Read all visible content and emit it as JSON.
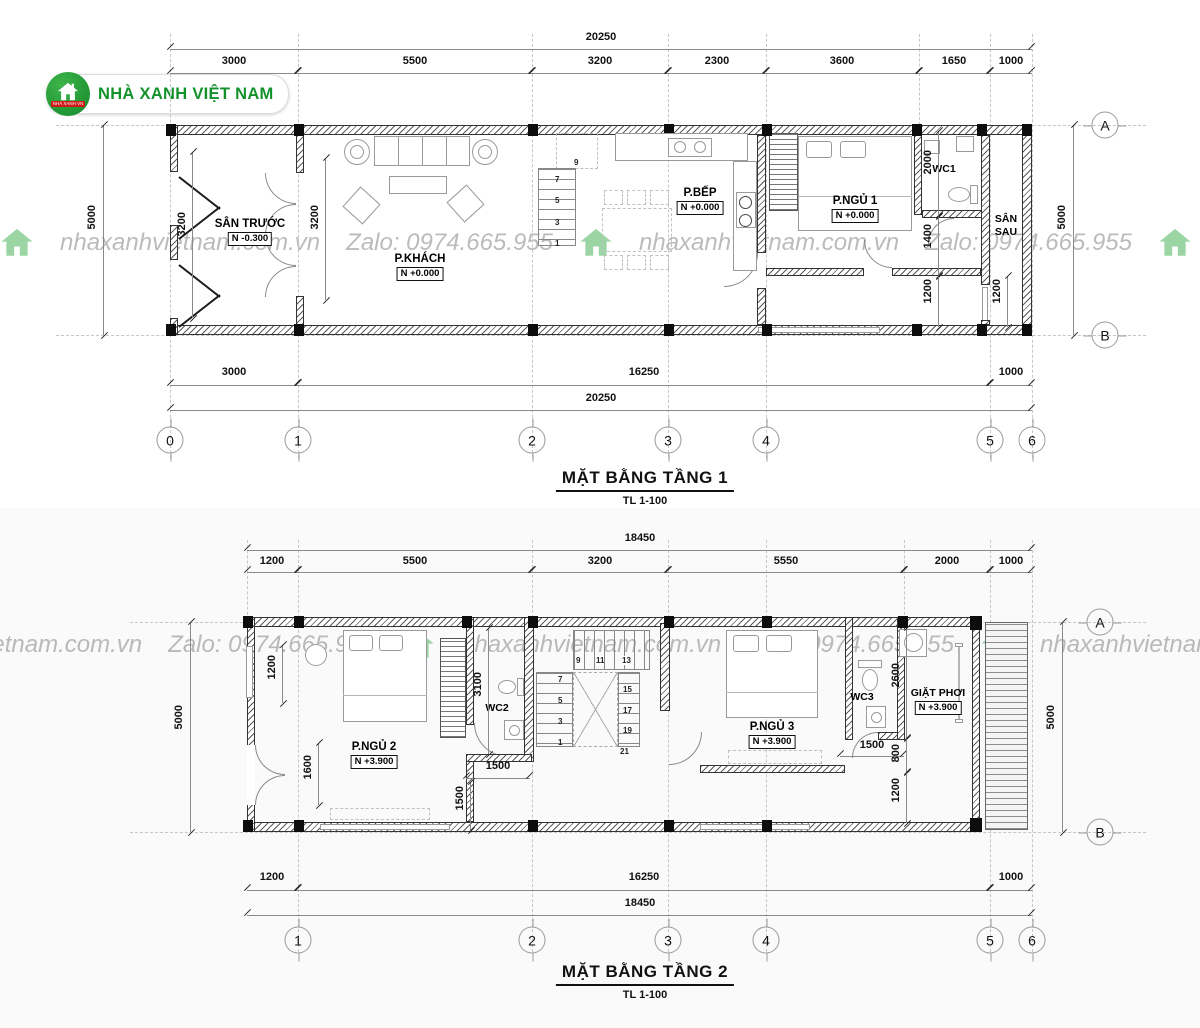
{
  "logo": {
    "name": "NHÀ XANH VIỆT NAM",
    "tag": "NHÀ XANH VN"
  },
  "watermark": {
    "site": "nhaxanhvietnam.com.vn",
    "zalo": "Zalo: 0974.665.955"
  },
  "colors": {
    "brand_green": "#1f9a31",
    "wall_black": "#111111",
    "line_gray": "#888888",
    "watermark_gray": "#9b9b9b"
  },
  "floor1": {
    "title": "MẶT BẰNG TẦNG 1",
    "scale": "TL 1-100",
    "top_total": "20250",
    "top_segments": [
      "3000",
      "5500",
      "3200",
      "2300",
      "3600",
      "1650",
      "1000"
    ],
    "bottom_segments": [
      "3000",
      "16250",
      "1000"
    ],
    "bottom_total": "20250",
    "side_total": "5000",
    "inner": {
      "san_truoc_w": "3200",
      "khach_w": "3200",
      "wc1_d": "2000",
      "hall_d": "1400",
      "back_d": "1200",
      "san_sau_d": "1200"
    },
    "grid_cols": [
      "0",
      "1",
      "2",
      "3",
      "4",
      "5",
      "6"
    ],
    "grid_rows": [
      "A",
      "B"
    ],
    "rooms": {
      "san_truoc": {
        "name": "SÂN TRƯỚC",
        "level": "N -0.300"
      },
      "khach": {
        "name": "P.KHÁCH",
        "level": "N +0.000"
      },
      "bep": {
        "name": "P.BẾP",
        "level": "N +0.000"
      },
      "ngu1": {
        "name": "P.NGỦ 1",
        "level": "N +0.000"
      },
      "wc1": {
        "name": "WC1"
      },
      "san_sau": {
        "line1": "SÂN",
        "line2": "SAU"
      }
    },
    "stair_numbers": [
      "1",
      "3",
      "5",
      "7",
      "9"
    ]
  },
  "floor2": {
    "title": "MẶT BẰNG TẦNG 2",
    "scale": "TL 1-100",
    "top_total": "18450",
    "top_segments": [
      "1200",
      "5500",
      "3200",
      "5550",
      "2000",
      "1000"
    ],
    "bottom_segments": [
      "1200",
      "16250",
      "1000"
    ],
    "bottom_total": "18450",
    "side_total": "5000",
    "inner": {
      "window_w": "1200",
      "door_w": "1600",
      "wc2_d": "3100",
      "wc2_w": "1500",
      "hall_w": "1500",
      "ngu3_w": "1500",
      "laundry_d": "2600",
      "ledge_d": "800",
      "back_d": "1200"
    },
    "grid_cols": [
      "1",
      "2",
      "3",
      "4",
      "5",
      "6"
    ],
    "grid_rows": [
      "A",
      "B"
    ],
    "rooms": {
      "ngu2": {
        "name": "P.NGỦ 2",
        "level": "N +3.900"
      },
      "wc2": {
        "name": "WC2"
      },
      "ngu3": {
        "name": "P.NGỦ 3",
        "level": "N +3.900"
      },
      "wc3": {
        "name": "WC3"
      },
      "giat": {
        "name": "GIẶT PHƠI",
        "level": "N +3.900"
      }
    },
    "stair_numbers": [
      "1",
      "3",
      "5",
      "7",
      "9",
      "11",
      "13",
      "15",
      "17",
      "19",
      "21"
    ]
  }
}
